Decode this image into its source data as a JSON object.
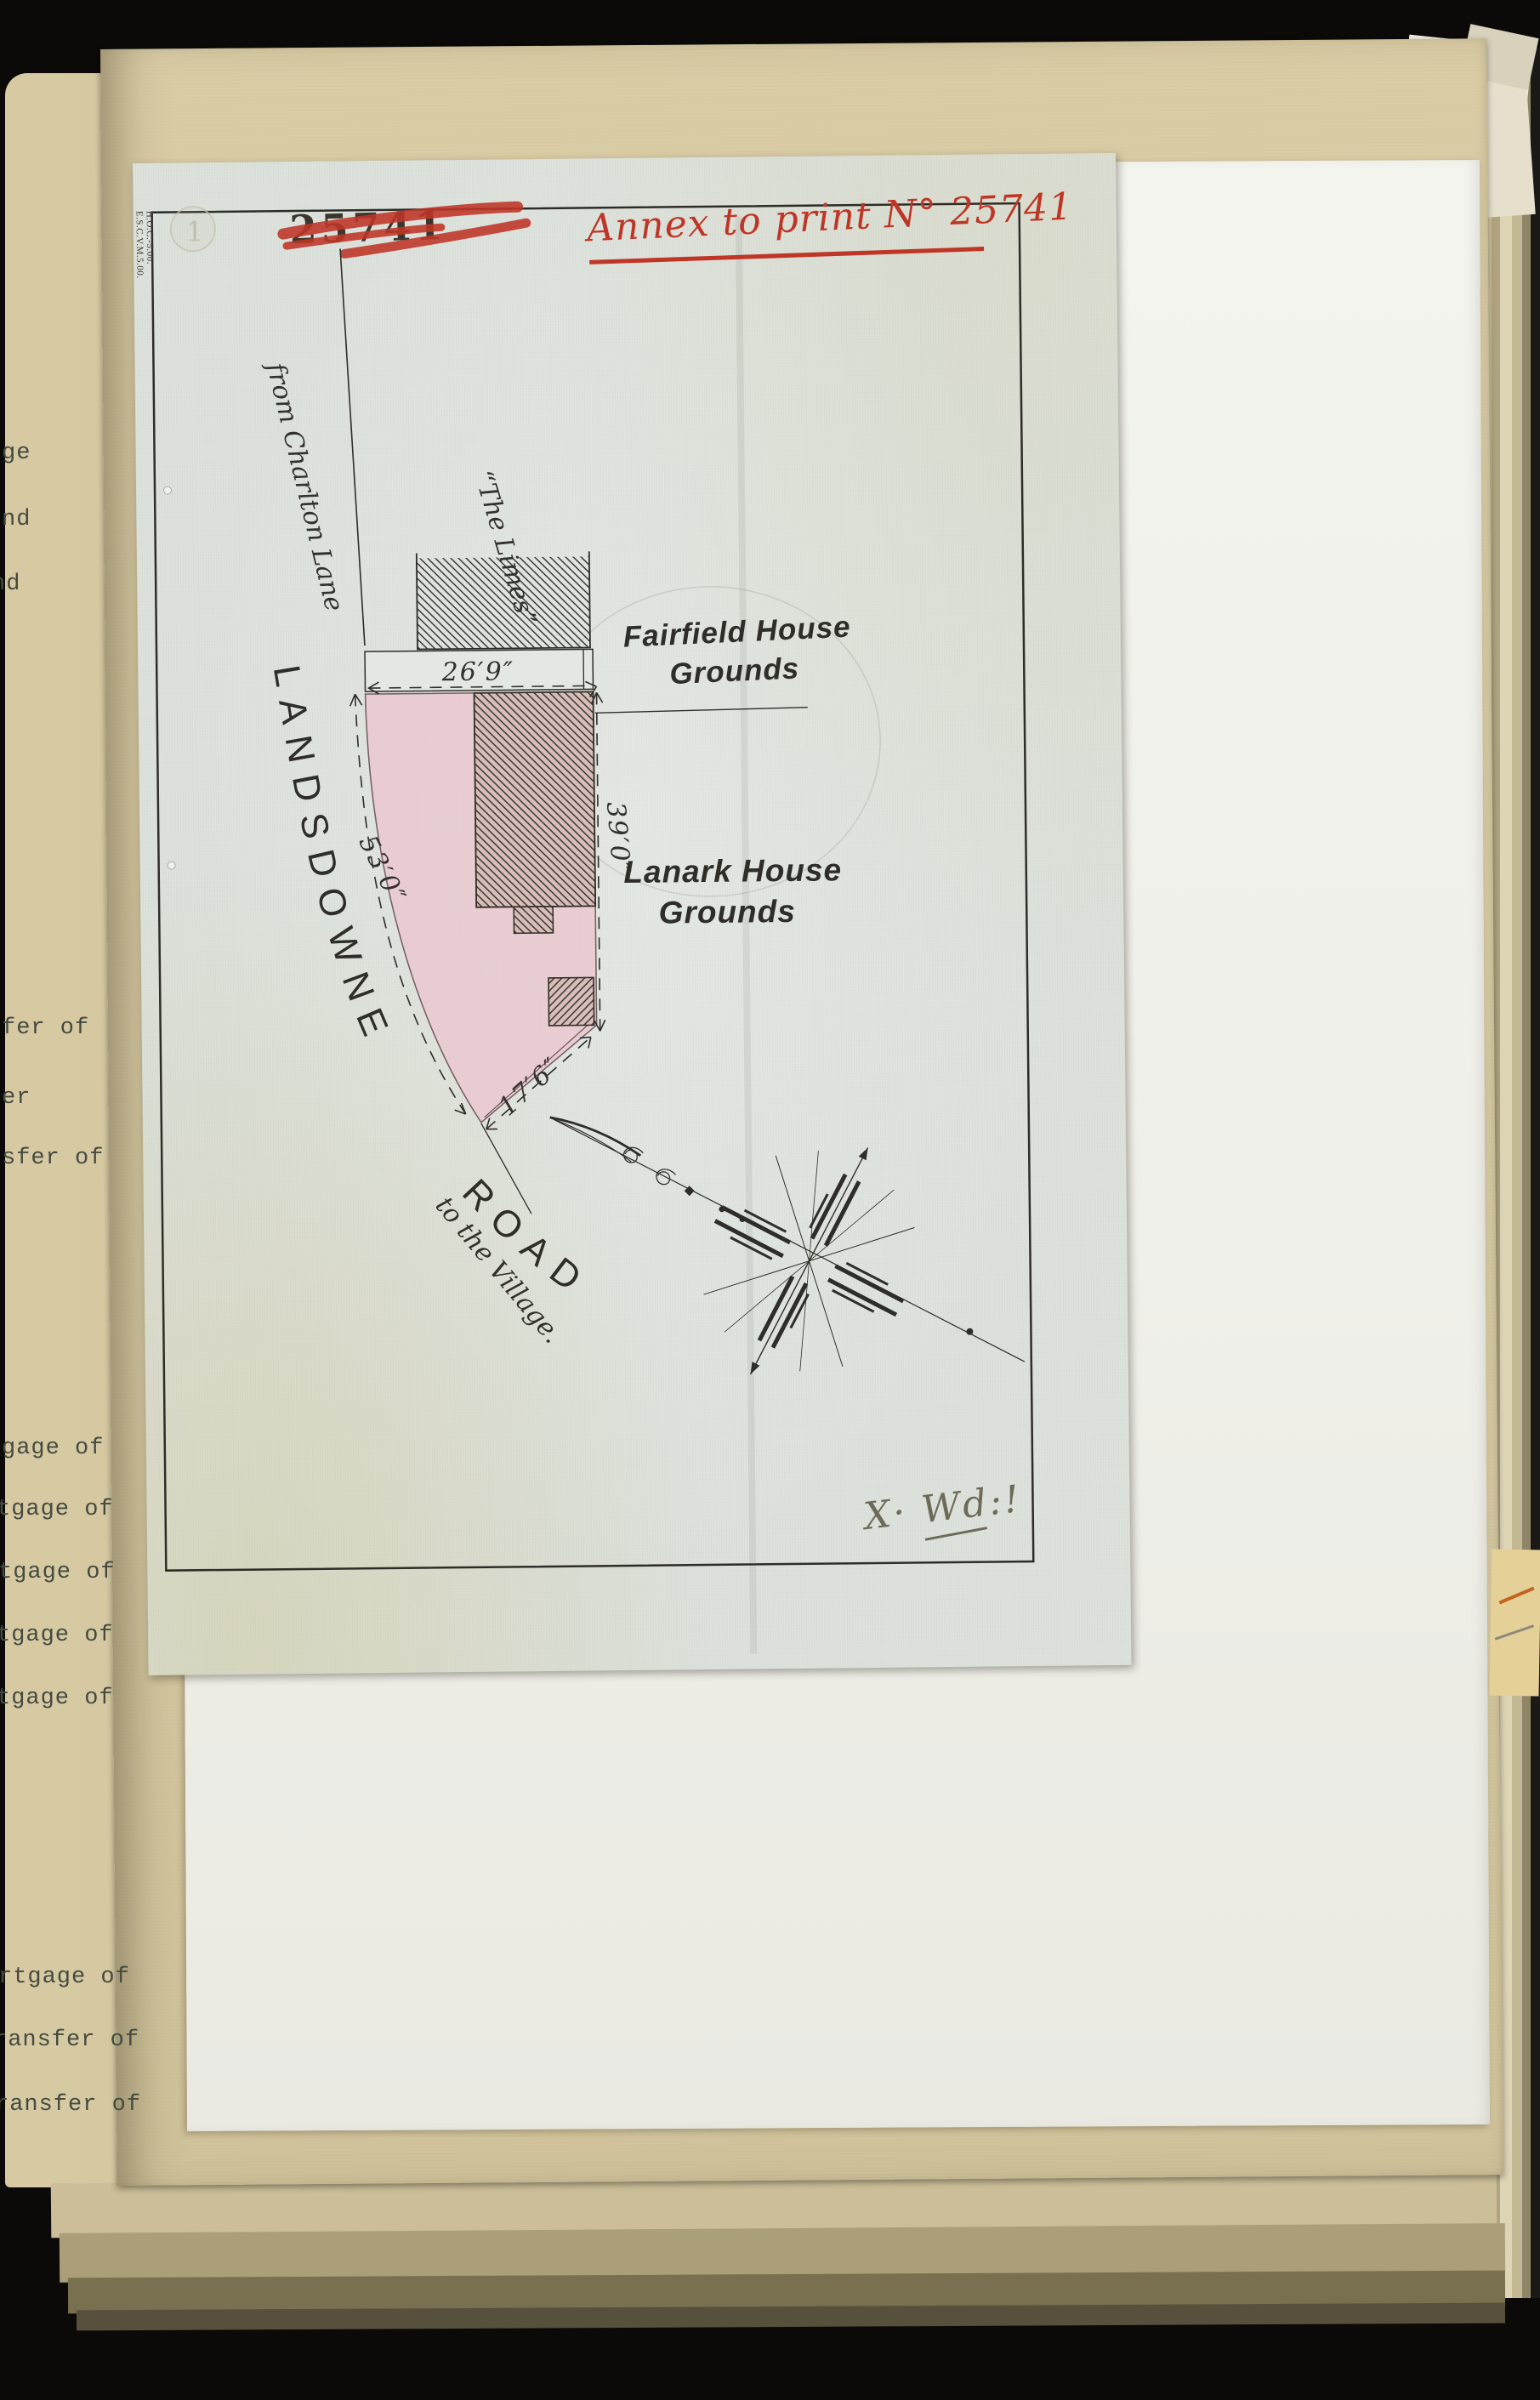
{
  "book": {
    "left_margin_fragments": [
      "ge",
      "nd",
      "nd",
      "fer of",
      "er",
      "sfer of",
      "gage of",
      "tgage of",
      "tgage of",
      "tgage of",
      "tgage of",
      "rtgage of",
      "ransfer of",
      "ransfer of"
    ]
  },
  "document": {
    "stamp_number": "25741",
    "red_annotation": "Annex to print N° 25741",
    "red_ink_color": "#bf3526",
    "print_code_1": "H.O.C.-5.00.",
    "print_code_2": "E.S.C.V.M.5.00.",
    "blind_stamp_numeral": "1",
    "examiner_mark": "X· Wd:!"
  },
  "map": {
    "labels": {
      "road_name_1": "LANDSDOWNE",
      "road_name_2": "ROAD",
      "from_road": "from Charlton Lane",
      "to_road": "to the Village.",
      "house_name": "“The Limes”",
      "north_grounds_1": "Fairfield House",
      "north_grounds_2": "Grounds",
      "east_grounds_1": "Lanark House",
      "east_grounds_2": "Grounds"
    },
    "measurements": {
      "north_frontage": "26′9″",
      "east_side": "39′0″",
      "west_side": "53′0″",
      "south_side": "17′6″"
    },
    "plot_fill_color": "#e9cbd1",
    "paper_color": "#dce1dc",
    "ink_color": "#2f2d28"
  }
}
